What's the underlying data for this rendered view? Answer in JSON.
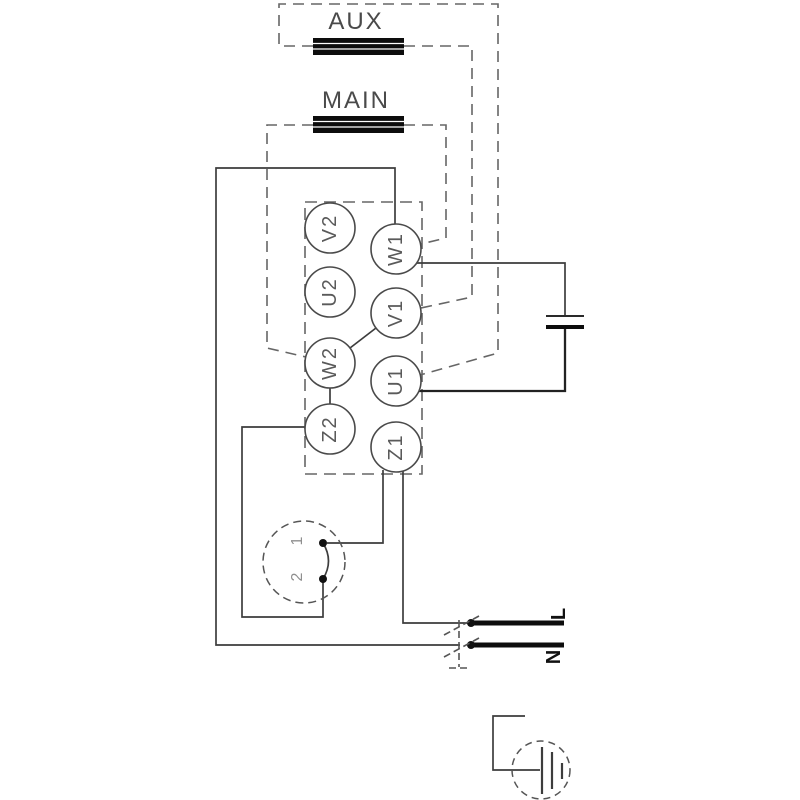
{
  "windings": {
    "aux_label": "AUX",
    "main_label": "MAIN"
  },
  "terminal_block": {
    "left_labels": [
      "V2",
      "U2",
      "W2",
      "Z2"
    ],
    "right_labels": [
      "W1",
      "V1",
      "U1",
      "Z1"
    ]
  },
  "centrifugal_switch": {
    "contact_top_label": "1",
    "contact_bottom_label": "2"
  },
  "supply": {
    "line_label": "L",
    "neutral_label": "N"
  },
  "colors": {
    "wire": "#3d3d3d",
    "dashed_wire": "#666666",
    "coil_fill": "#0d0d0d",
    "supply_bar": "#0d0d0d",
    "label_text": "#5a5a5a"
  }
}
